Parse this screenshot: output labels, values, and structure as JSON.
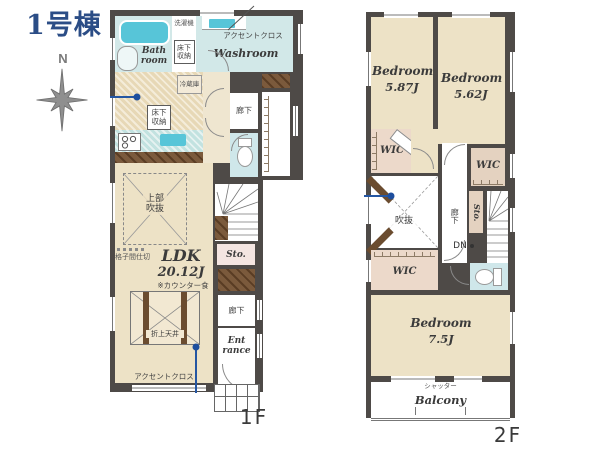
{
  "title": "1号棟",
  "compass": {
    "north": "N"
  },
  "floor1": {
    "floor_label": "1F",
    "bath": {
      "label": "Bath room"
    },
    "laundry": {
      "label": "洗濯機"
    },
    "underfloor_storage_upper": {
      "label": "床下収納"
    },
    "washroom": {
      "label": "Washroom",
      "accent_cloth": "アクセントクロス"
    },
    "kitchen": {
      "fridge": "冷蔵庫",
      "underfloor_storage": "床下収納"
    },
    "hall_upper": {
      "label": "廊下"
    },
    "stairs": {
      "up": "UP",
      "counter": "カウンター"
    },
    "storage": {
      "label": "Sto."
    },
    "ldk": {
      "name": "LDK",
      "size": "20.12J",
      "counter_note": "※カウンター食",
      "open_ceiling": "上部吹抜",
      "lattice_partition": "格子間仕切",
      "coffered_ceiling": "折上天井",
      "accent_cloth": "アクセントクロス"
    },
    "hall_lower": {
      "label": "廊下"
    },
    "entrance": {
      "label": "Ent rance"
    }
  },
  "floor2": {
    "floor_label": "2F",
    "bedroom_left": {
      "name": "Bedroom",
      "size": "5.87J"
    },
    "bedroom_right": {
      "name": "Bedroom",
      "size": "5.62J"
    },
    "bedroom_main": {
      "name": "Bedroom",
      "size": "7.5J"
    },
    "wic_upper_left": {
      "label": "WIC"
    },
    "wic_right": {
      "label": "WIC"
    },
    "wic_lower_left": {
      "label": "WIC"
    },
    "void": {
      "label": "吹抜"
    },
    "hall": {
      "label": "廊下"
    },
    "storage": {
      "label": "Sto."
    },
    "stairs": {
      "down": "DN"
    },
    "balcony": {
      "label": "Balcony",
      "shutter": "シャッター"
    }
  },
  "colors": {
    "title_blue": "#2b4d86",
    "annotation_blue": "#2456a2",
    "wall": "#4e4a47",
    "room_beige": "#ede2c6",
    "wet_area": "#d2e8e8",
    "fixture_cyan": "#57c5d8",
    "wic_tan": "#ecd9ca",
    "storage_pink": "#f4e5e1",
    "wood_brown": "#6b4c2f",
    "compass_gray": "#8f8f8f"
  }
}
